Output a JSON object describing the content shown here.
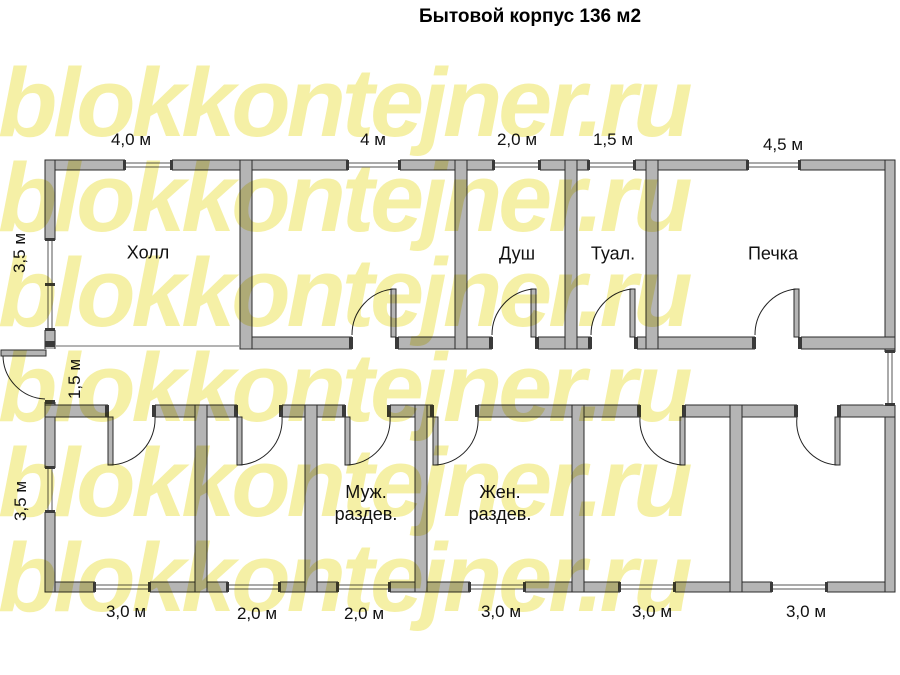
{
  "title": "Бытовой корпус 136 м2",
  "watermark": {
    "text": "blokkontejner.ru",
    "color": "#f5f0a6"
  },
  "rooms": {
    "hall": "Холл",
    "shower": "Душ",
    "toilet": "Туал.",
    "stove": "Печка",
    "mens": {
      "line1": "Муж.",
      "line2": "раздев."
    },
    "womens": {
      "line1": "Жен.",
      "line2": "раздев."
    }
  },
  "dims": {
    "top": [
      "4,0 м",
      "4 м",
      "2,0 м",
      "1,5 м",
      "4,5 м"
    ],
    "bottom": [
      "3,0 м",
      "2,0 м",
      "2,0 м",
      "3,0 м",
      "3,0 м",
      "3,0 м"
    ],
    "left_top": "3,5 м",
    "corridor": "1,5 м",
    "left_bottom": "3,5 м"
  },
  "colors": {
    "wall_fill": "#b5b5b5",
    "wall_stroke": "#2b2b2b",
    "cap_fill": "#3a3a3a",
    "watermark": "#f5f0a6",
    "text": "#111111"
  }
}
